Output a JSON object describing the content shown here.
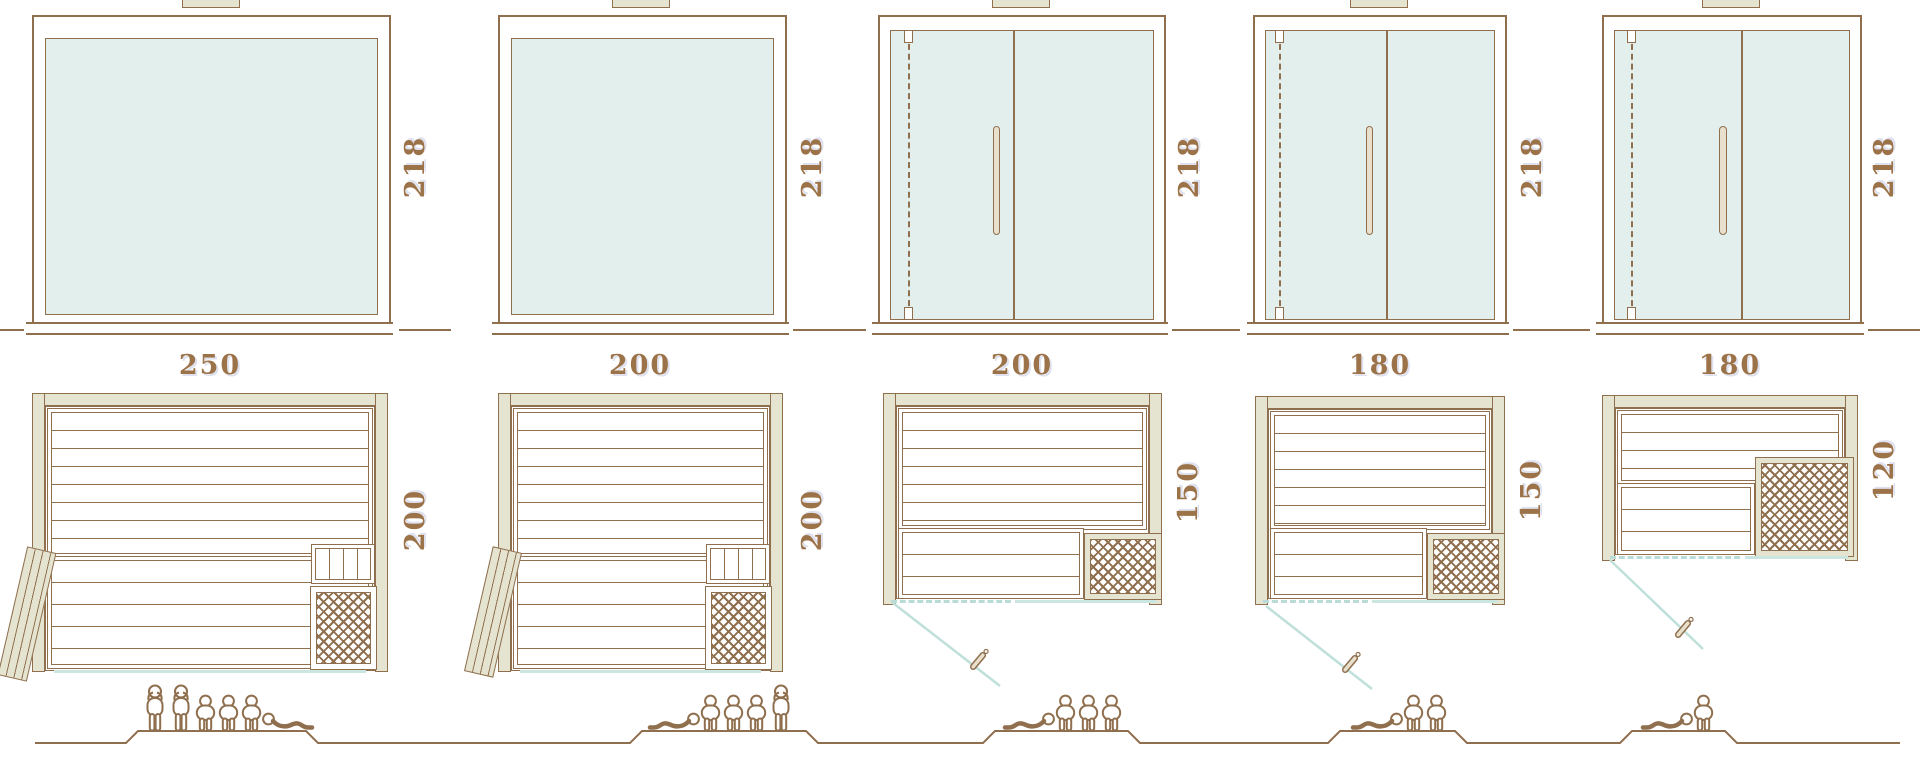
{
  "diagram_type": "sauna-size-comparison",
  "colors": {
    "line_brown": "#8f6f4e",
    "label_brown": "#9c7349",
    "glass_fill": "#e3efec",
    "wall_fill": "#e5e4d0",
    "glass_front_teal": "#cbe5e0",
    "background": "#ffffff"
  },
  "units": [
    {
      "width": "250",
      "height": "218",
      "depth": "200",
      "front": "full-glass-panel",
      "door": "side-hinged-leaf",
      "capacity": {
        "standing": 2,
        "sitting": 3,
        "lying": 1,
        "arrangement": [
          "stand",
          "stand",
          "sit",
          "sit",
          "sit",
          "lie"
        ]
      }
    },
    {
      "width": "200",
      "height": "218",
      "depth": "200",
      "front": "full-glass-panel",
      "door": "side-hinged-leaf",
      "capacity": {
        "standing": 1,
        "sitting": 3,
        "lying": 1,
        "arrangement": [
          "lie-m",
          "sit",
          "sit",
          "sit",
          "stand"
        ]
      }
    },
    {
      "width": "200",
      "height": "218",
      "depth": "150",
      "front": "glass-door-front",
      "door": "hinged-glass-door",
      "capacity": {
        "standing": 0,
        "sitting": 3,
        "lying": 1,
        "arrangement": [
          "lie-m",
          "sit",
          "sit",
          "sit"
        ]
      }
    },
    {
      "width": "180",
      "height": "218",
      "depth": "150",
      "front": "glass-door-front",
      "door": "hinged-glass-door",
      "capacity": {
        "standing": 0,
        "sitting": 2,
        "lying": 1,
        "arrangement": [
          "lie-m",
          "sit",
          "sit"
        ]
      }
    },
    {
      "width": "180",
      "height": "218",
      "depth": "120",
      "front": "glass-door-front",
      "door": "hinged-glass-door",
      "capacity": {
        "standing": 0,
        "sitting": 1,
        "lying": 1,
        "arrangement": [
          "lie-m",
          "sit"
        ]
      }
    }
  ]
}
